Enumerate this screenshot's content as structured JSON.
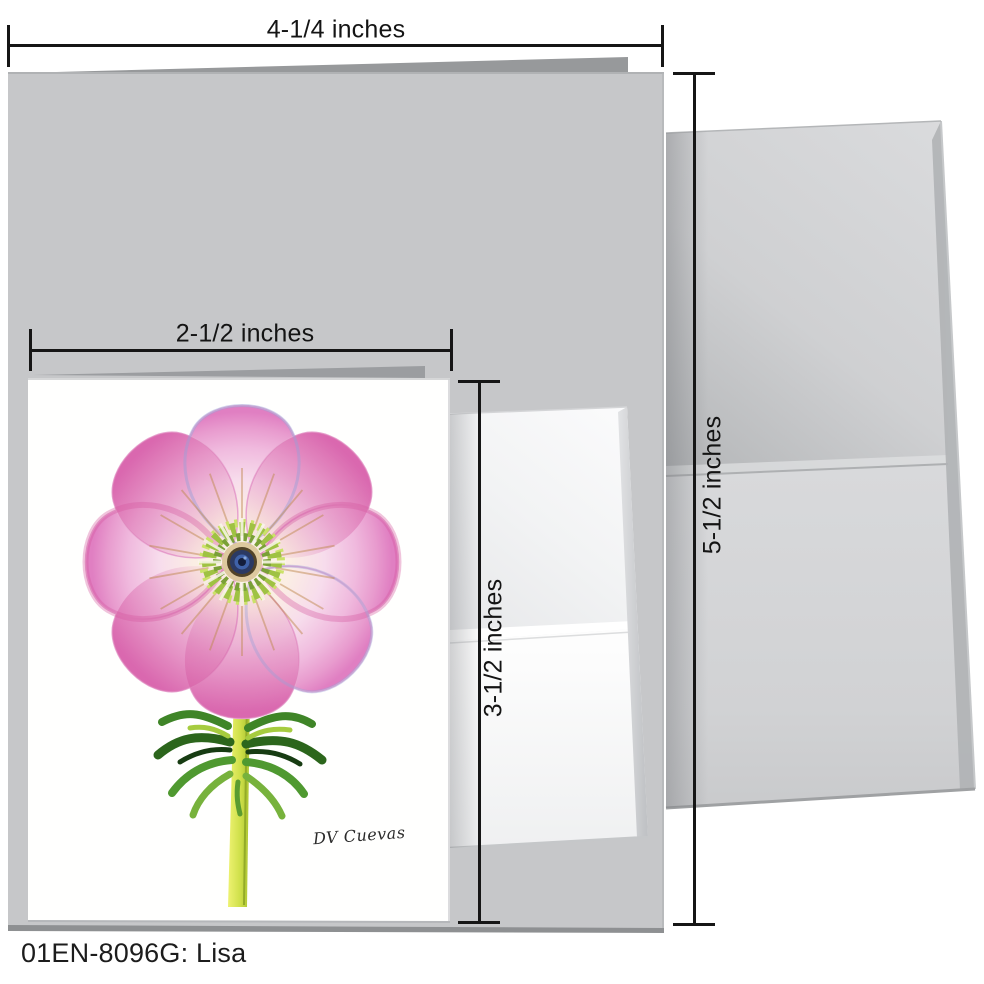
{
  "product": {
    "caption": "01EN-8096G: Lisa",
    "artist_signature": "DV Cuevas"
  },
  "dimension_labels": {
    "folded_card_width": "4-1/4 inches",
    "folded_card_height": "5-1/2 inches",
    "notecard_width": "2-1/2 inches",
    "notecard_height": "3-1/2 inches"
  },
  "colors": {
    "dimension_line": "#161616",
    "large_card_gray": "#c6c7c9",
    "card_back_page_gray": "#97999b",
    "large_envelope_gray": "#d3d4d6",
    "envelope_fold_gray": "#b0b2b5",
    "small_card_white": "#fefefe",
    "small_envelope_white": "#f8f9fa",
    "petal_cream": "#fdf6e8",
    "petal_pink": "#e48cc8",
    "petal_deep_pink": "#d4559f",
    "petal_lavender": "#9aa0d8",
    "stamen_ray_tan": "#c08a52",
    "stamen_green": "#9fc243",
    "stamen_light_green": "#cbe268",
    "center_ring_tan": "#ddc99e",
    "center_navy": "#2b3a63",
    "center_blue": "#3f62a8",
    "stem_yellow_green": "#cfe04a",
    "leaf_green": "#3f8527",
    "leaf_dark_green": "#173c12"
  }
}
